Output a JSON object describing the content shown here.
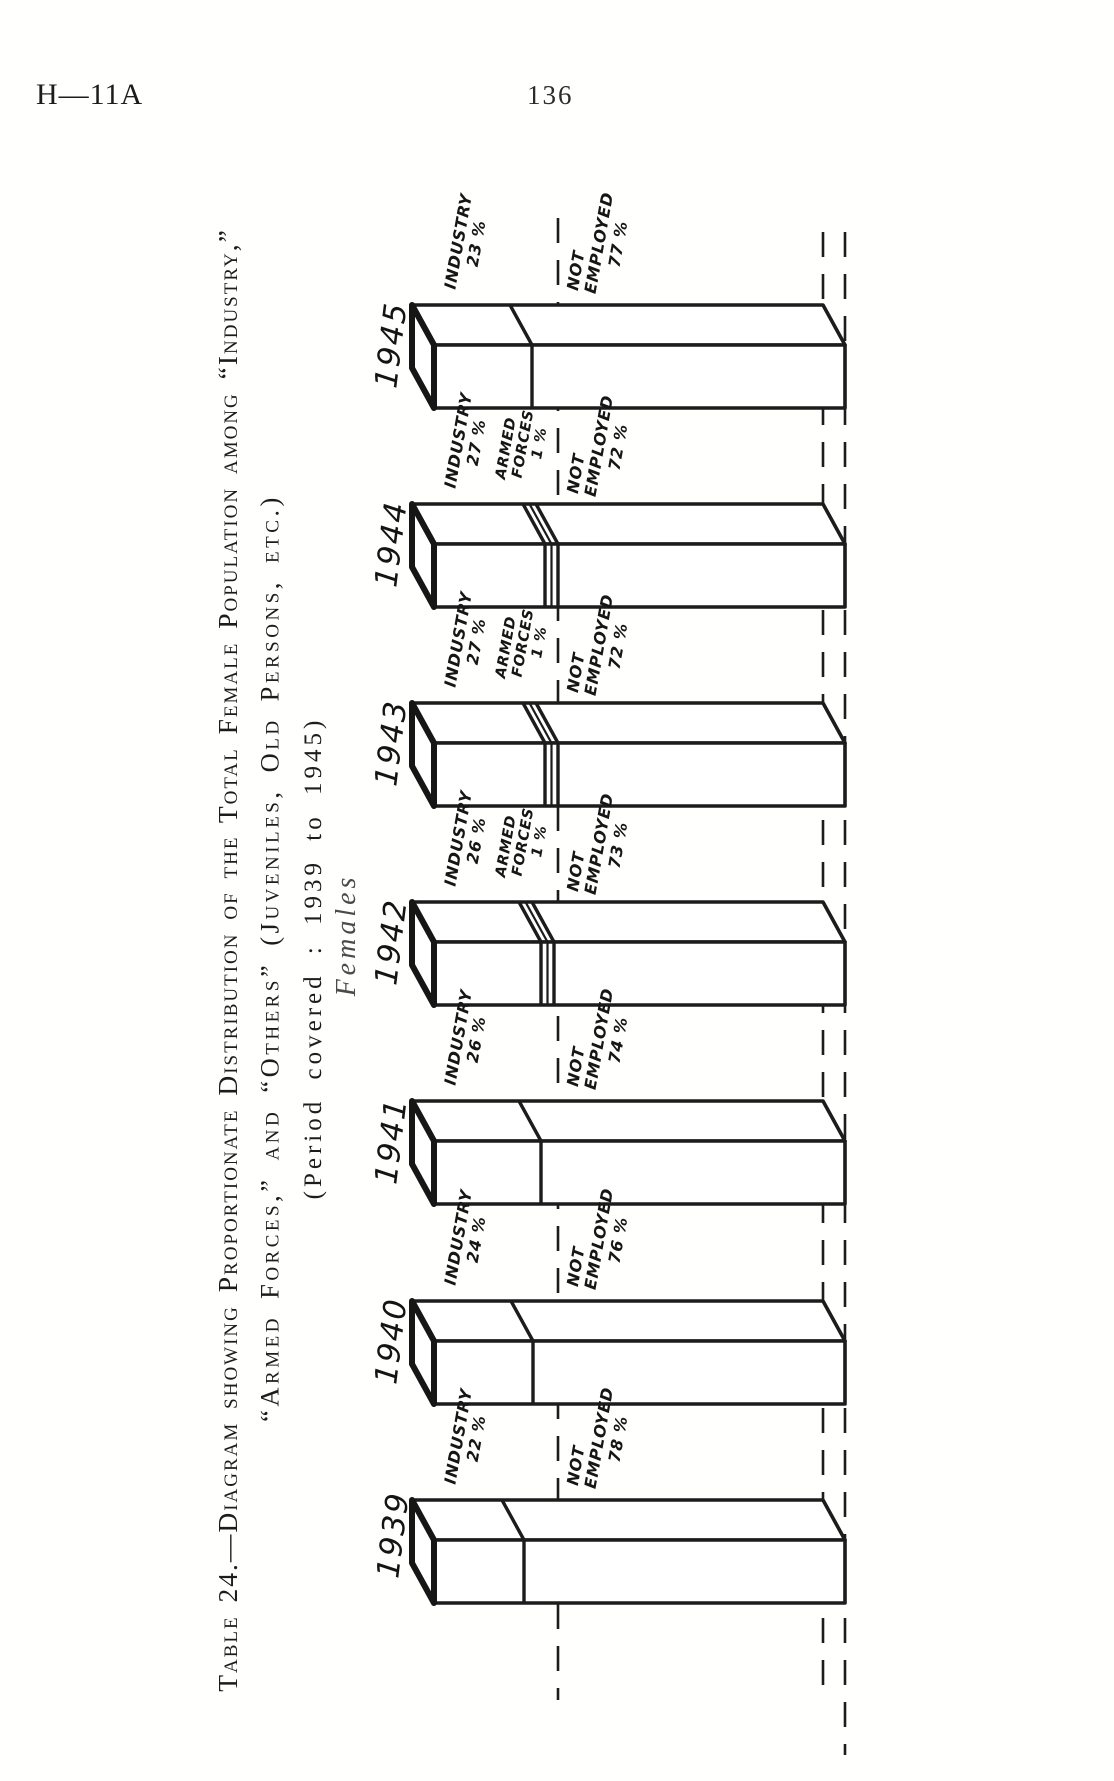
{
  "header": {
    "left": "H—11A",
    "page_number": "136"
  },
  "title": {
    "line1": "Table 24.—Diagram showing Proportionate Distribution of the Total Female Population among “Industry,”",
    "line2": "“Armed Forces,” and “Others” (Juveniles, Old Persons, etc.)",
    "line3": "(Period covered : 1939 to 1945)",
    "subtitle": "Females"
  },
  "colors": {
    "ink": "#1c1c1c",
    "paper": "#ffffff"
  },
  "chart_data": {
    "type": "bar",
    "stacked": true,
    "orientation": "horizontal bars on a page rotated 90 degrees",
    "unit": "% of total female population",
    "period": "1939 to 1945",
    "title": "Proportionate Distribution of the Total Female Population among Industry, Armed Forces and Others",
    "subtitle": "Females",
    "categories": [
      "1945",
      "1944",
      "1943",
      "1942",
      "1941",
      "1940",
      "1939"
    ],
    "series": [
      {
        "name": "Industry",
        "values": [
          23,
          27,
          27,
          26,
          26,
          24,
          22
        ]
      },
      {
        "name": "Armed Forces",
        "values": [
          0,
          1,
          1,
          1,
          0,
          0,
          0
        ]
      },
      {
        "name": "Not Employed",
        "values": [
          77,
          72,
          72,
          73,
          74,
          76,
          78
        ]
      }
    ],
    "bars": [
      {
        "industry": {
          "l1": "INDUSTRY",
          "l2": "23 %"
        },
        "not_employed": {
          "l1": "NOT",
          "l2": "EMPLOYED",
          "l3": "77 %"
        }
      },
      {
        "industry": {
          "l1": "INDUSTRY",
          "l2": "27 %"
        },
        "armed_forces": {
          "l1": "ARMED",
          "l2": "FORCES",
          "l3": "1 %"
        },
        "not_employed": {
          "l1": "NOT",
          "l2": "EMPLOYED",
          "l3": "72 %"
        }
      },
      {
        "industry": {
          "l1": "INDUSTRY",
          "l2": "27 %"
        },
        "armed_forces": {
          "l1": "ARMED",
          "l2": "FORCES",
          "l3": "1 %"
        },
        "not_employed": {
          "l1": "NOT",
          "l2": "EMPLOYED",
          "l3": "72 %"
        }
      },
      {
        "industry": {
          "l1": "INDUSTRY",
          "l2": "26 %"
        },
        "armed_forces": {
          "l1": "ARMED",
          "l2": "FORCES",
          "l3": "1 %"
        },
        "not_employed": {
          "l1": "NOT",
          "l2": "EMPLOYED",
          "l3": "73 %"
        }
      },
      {
        "industry": {
          "l1": "INDUSTRY",
          "l2": "26 %"
        },
        "not_employed": {
          "l1": "NOT",
          "l2": "EMPLOYED",
          "l3": "74 %"
        }
      },
      {
        "industry": {
          "l1": "INDUSTRY",
          "l2": "24 %"
        },
        "not_employed": {
          "l1": "NOT",
          "l2": "EMPLOYED",
          "l3": "76 %"
        }
      },
      {
        "industry": {
          "l1": "INDUSTRY",
          "l2": "22 %"
        },
        "not_employed": {
          "l1": "NOT",
          "l2": "EMPLOYED",
          "l3": "78 %"
        }
      }
    ]
  }
}
